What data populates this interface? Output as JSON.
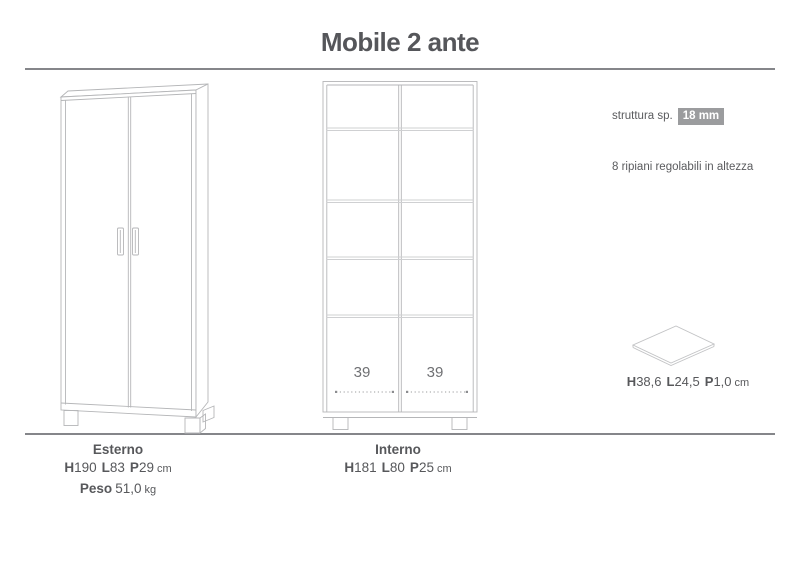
{
  "title": "Mobile 2 ante",
  "specs": {
    "struttura_label": "struttura sp.",
    "struttura_value": "18 mm",
    "ripiani_note": "8 ripiani regolabili in altezza",
    "panel": {
      "h_label": "H",
      "h_value": "38,6",
      "l_label": "L",
      "l_value": "24,5",
      "p_label": "P",
      "p_value": "1,0",
      "unit": "cm"
    }
  },
  "interior_dims": {
    "left_compartment_width": "39",
    "right_compartment_width": "39"
  },
  "footer": {
    "esterno": {
      "label": "Esterno",
      "h_label": "H",
      "h_value": "190",
      "l_label": "L",
      "l_value": "83",
      "p_label": "P",
      "p_value": "29",
      "unit": "cm",
      "peso_label": "Peso",
      "peso_value": "51,0",
      "peso_unit": "kg"
    },
    "interno": {
      "label": "Interno",
      "h_label": "H",
      "h_value": "181",
      "l_label": "L",
      "l_value": "80",
      "p_label": "P",
      "p_value": "25",
      "unit": "cm"
    }
  },
  "colors": {
    "accent_badge_bg": "#9b9c9e",
    "drawing_line": "#b5b6b8",
    "shelf_line": "#cfd0d2",
    "rule_line": "#85868a",
    "text": "#57585b"
  }
}
